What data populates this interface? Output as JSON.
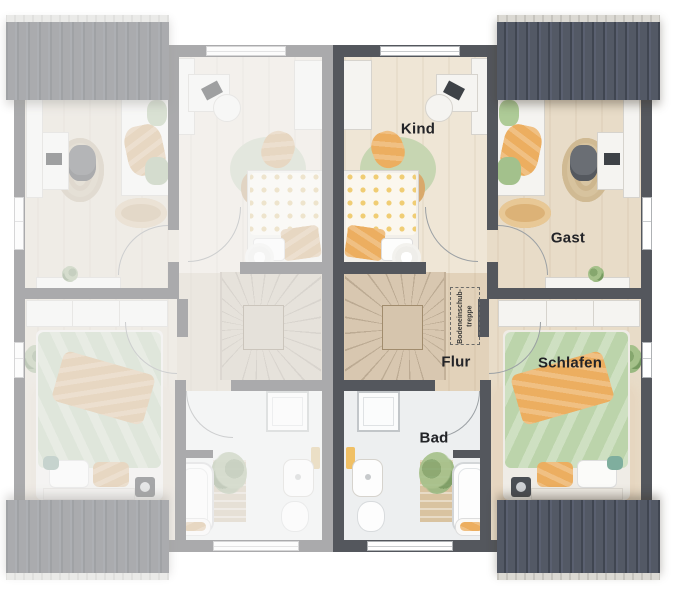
{
  "plan": {
    "rooms": {
      "kind": {
        "label": "Kind"
      },
      "gast": {
        "label": "Gast"
      },
      "flur": {
        "label": "Flur"
      },
      "schlafen": {
        "label": "Schlafen"
      },
      "bad": {
        "label": "Bad"
      }
    },
    "annotations": {
      "attic_hatch": {
        "line1": "Bodeneinschub-",
        "line2": "treppe"
      }
    },
    "colors": {
      "wall": "#54575d",
      "roof_dark": "#4b515b",
      "roof_ridge": "#dbd9d3",
      "floor_wood": "#e8dcc8",
      "floor_bath": "#edeff0",
      "accent_orange": "#ecae60",
      "accent_green": "#bcd4ab",
      "label_text": "#232428"
    }
  }
}
